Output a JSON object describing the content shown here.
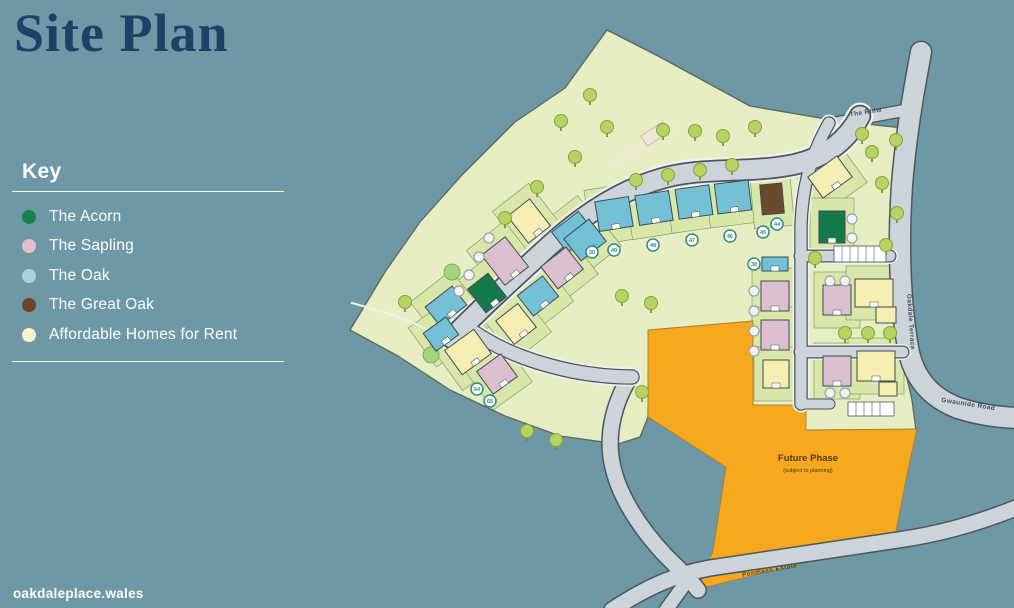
{
  "page": {
    "title": "Site Plan",
    "website": "oakdaleplace.wales"
  },
  "key": {
    "heading": "Key",
    "items": [
      {
        "label": "The Acorn",
        "color": "#17804f"
      },
      {
        "label": "The Sapling",
        "color": "#e7bfcc"
      },
      {
        "label": "The Oak",
        "color": "#a6d3de"
      },
      {
        "label": "The Great Oak",
        "color": "#6a4527"
      },
      {
        "label": "Affordable Homes for Rent",
        "color": "#f9f3d0"
      }
    ]
  },
  "colors": {
    "teal": "#6e98a6",
    "title-navy": "#1d4166",
    "text-white": "#ffffff",
    "site-green": "#e7eec4",
    "site-outline": "#5a6857",
    "garden-green": "#d9e7a9",
    "garden-line": "#7c8a60",
    "lawn-green": "#a3d47e",
    "road-fill": "#ced5da",
    "road-casing": "#4a5660",
    "sidewalk": "#f1f2ec",
    "orange": "#f6a81f",
    "tree-fill": "#b7d363",
    "tree-stroke": "#82a63c",
    "outline-dark": "#3d4b55",
    "marker-teal": "#2e8b80",
    "marker-gray": "#98a2ab",
    "label-dark": "#3f4d58",
    "path-pale": "#f0e6da",
    "future-text": "#4c3c0e"
  },
  "map": {
    "road_labels": [
      {
        "text": "The Rhiw"
      },
      {
        "text": "Oakdale Terrace"
      },
      {
        "text": "Gwaunide Road"
      },
      {
        "text": "Penmaen Estate"
      }
    ],
    "future_phase": {
      "title": "Future Phase",
      "subtitle": "(subject to planning)"
    },
    "house_colors": {
      "acorn": "#157a4a",
      "sapling": "#dcc0cf",
      "oak": "#74c1d5",
      "great_oak": "#6b4a2c",
      "affordable": "#f6eeb2"
    },
    "houses": [
      {
        "x": 614,
        "y": 214,
        "w": 34,
        "h": 30,
        "r": -9,
        "t": "oak"
      },
      {
        "x": 654,
        "y": 208,
        "w": 34,
        "h": 30,
        "r": -9,
        "t": "oak"
      },
      {
        "x": 694,
        "y": 202,
        "w": 34,
        "h": 30,
        "r": -8,
        "t": "oak"
      },
      {
        "x": 733,
        "y": 197,
        "w": 34,
        "h": 30,
        "r": -7,
        "t": "oak"
      },
      {
        "x": 772,
        "y": 199,
        "w": 22,
        "h": 30,
        "r": -5,
        "t": "great_oak"
      },
      {
        "x": 573,
        "y": 232,
        "w": 34,
        "h": 26,
        "r": -38,
        "t": "oak"
      },
      {
        "x": 529,
        "y": 221,
        "w": 28,
        "h": 34,
        "r": -38,
        "t": "affordable"
      },
      {
        "x": 505,
        "y": 261,
        "w": 30,
        "h": 38,
        "r": -38,
        "t": "sapling"
      },
      {
        "x": 487,
        "y": 293,
        "w": 26,
        "h": 30,
        "r": -38,
        "t": "acorn"
      },
      {
        "x": 446,
        "y": 306,
        "w": 34,
        "h": 24,
        "r": -38,
        "t": "oak"
      },
      {
        "x": 585,
        "y": 240,
        "w": 32,
        "h": 28,
        "r": -38,
        "t": "oak"
      },
      {
        "x": 562,
        "y": 268,
        "w": 32,
        "h": 28,
        "r": -38,
        "t": "sapling"
      },
      {
        "x": 538,
        "y": 296,
        "w": 32,
        "h": 26,
        "r": -38,
        "t": "oak"
      },
      {
        "x": 516,
        "y": 324,
        "w": 28,
        "h": 30,
        "r": -38,
        "t": "affordable"
      },
      {
        "x": 441,
        "y": 334,
        "w": 28,
        "h": 22,
        "r": -36,
        "t": "oak"
      },
      {
        "x": 468,
        "y": 352,
        "w": 36,
        "h": 30,
        "r": -36,
        "t": "affordable"
      },
      {
        "x": 497,
        "y": 374,
        "w": 30,
        "h": 28,
        "r": -36,
        "t": "sapling"
      },
      {
        "x": 775,
        "y": 264,
        "w": 26,
        "h": 14,
        "r": 0,
        "t": "oak",
        "g": 0
      },
      {
        "x": 775,
        "y": 296,
        "w": 28,
        "h": 30,
        "r": 0,
        "t": "sapling"
      },
      {
        "x": 775,
        "y": 335,
        "w": 28,
        "h": 30,
        "r": 0,
        "t": "sapling"
      },
      {
        "x": 776,
        "y": 374,
        "w": 26,
        "h": 28,
        "r": 0,
        "t": "affordable"
      },
      {
        "x": 830,
        "y": 177,
        "w": 36,
        "h": 26,
        "r": -36,
        "t": "affordable"
      },
      {
        "x": 832,
        "y": 227,
        "w": 26,
        "h": 32,
        "r": 0,
        "t": "acorn"
      },
      {
        "x": 837,
        "y": 300,
        "w": 28,
        "h": 30,
        "r": 0,
        "t": "sapling"
      },
      {
        "x": 874,
        "y": 293,
        "w": 38,
        "h": 28,
        "r": 0,
        "t": "affordable"
      },
      {
        "x": 886,
        "y": 315,
        "w": 20,
        "h": 16,
        "r": 0,
        "t": "affordable",
        "g": 0
      },
      {
        "x": 837,
        "y": 371,
        "w": 28,
        "h": 30,
        "r": 0,
        "t": "sapling"
      },
      {
        "x": 876,
        "y": 366,
        "w": 38,
        "h": 30,
        "r": 0,
        "t": "affordable"
      },
      {
        "x": 888,
        "y": 389,
        "w": 18,
        "h": 14,
        "r": 0,
        "t": "affordable",
        "g": 0
      }
    ],
    "trees": [
      {
        "x": 590,
        "y": 95
      },
      {
        "x": 561,
        "y": 121
      },
      {
        "x": 607,
        "y": 127
      },
      {
        "x": 575,
        "y": 157
      },
      {
        "x": 537,
        "y": 187
      },
      {
        "x": 505,
        "y": 218
      },
      {
        "x": 663,
        "y": 130
      },
      {
        "x": 695,
        "y": 131
      },
      {
        "x": 723,
        "y": 136
      },
      {
        "x": 755,
        "y": 127
      },
      {
        "x": 636,
        "y": 180
      },
      {
        "x": 668,
        "y": 175
      },
      {
        "x": 700,
        "y": 170
      },
      {
        "x": 732,
        "y": 165
      },
      {
        "x": 862,
        "y": 134
      },
      {
        "x": 872,
        "y": 152
      },
      {
        "x": 896,
        "y": 140
      },
      {
        "x": 882,
        "y": 183
      },
      {
        "x": 897,
        "y": 213
      },
      {
        "x": 886,
        "y": 245
      },
      {
        "x": 622,
        "y": 296
      },
      {
        "x": 651,
        "y": 303
      },
      {
        "x": 845,
        "y": 333
      },
      {
        "x": 868,
        "y": 333
      },
      {
        "x": 890,
        "y": 333
      },
      {
        "x": 527,
        "y": 431
      },
      {
        "x": 556,
        "y": 440
      },
      {
        "x": 642,
        "y": 392
      },
      {
        "x": 405,
        "y": 302
      },
      {
        "x": 815,
        "y": 258
      }
    ],
    "plot_markers": [
      {
        "x": 592,
        "y": 252,
        "label": "50"
      },
      {
        "x": 614,
        "y": 250,
        "label": "49"
      },
      {
        "x": 653,
        "y": 245,
        "label": "48"
      },
      {
        "x": 692,
        "y": 240,
        "label": "47"
      },
      {
        "x": 730,
        "y": 236,
        "label": "46"
      },
      {
        "x": 763,
        "y": 232,
        "label": "45"
      },
      {
        "x": 777,
        "y": 224,
        "label": "44"
      },
      {
        "x": 754,
        "y": 264,
        "label": "38"
      },
      {
        "x": 477,
        "y": 389,
        "label": "64"
      },
      {
        "x": 490,
        "y": 401,
        "label": "65"
      }
    ],
    "dot_markers": [
      {
        "x": 852,
        "y": 219
      },
      {
        "x": 852,
        "y": 238
      },
      {
        "x": 754,
        "y": 291
      },
      {
        "x": 754,
        "y": 311
      },
      {
        "x": 754,
        "y": 331
      },
      {
        "x": 754,
        "y": 351
      },
      {
        "x": 830,
        "y": 281
      },
      {
        "x": 845,
        "y": 281
      },
      {
        "x": 830,
        "y": 393
      },
      {
        "x": 845,
        "y": 393
      },
      {
        "x": 489,
        "y": 238
      },
      {
        "x": 479,
        "y": 257
      },
      {
        "x": 469,
        "y": 275
      },
      {
        "x": 459,
        "y": 291
      }
    ],
    "lawns": [
      {
        "x": 431,
        "y": 355
      },
      {
        "x": 452,
        "y": 272
      }
    ]
  }
}
